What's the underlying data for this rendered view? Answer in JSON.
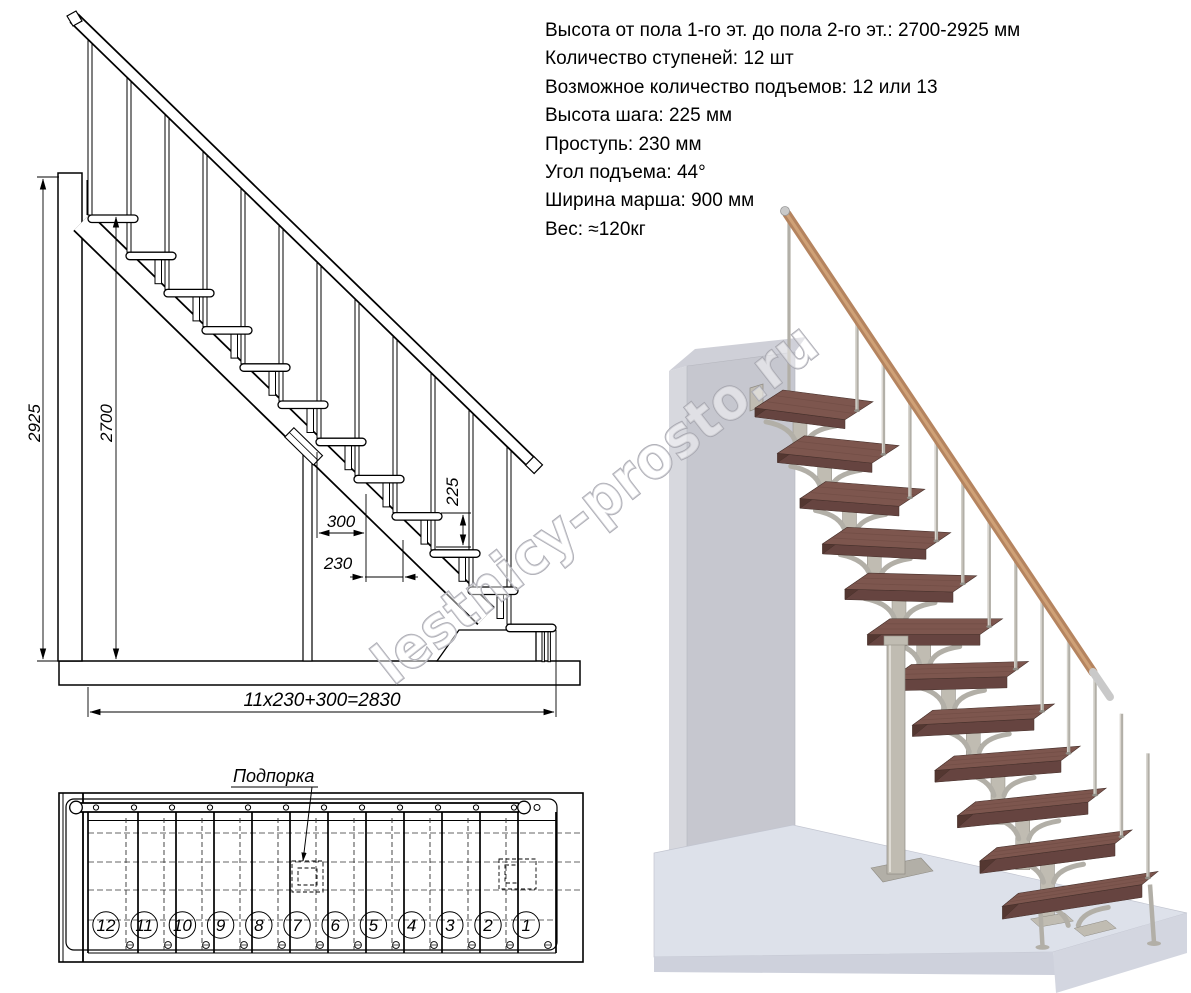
{
  "specs": {
    "lines": [
      "Высота от пола 1-го эт. до пола 2-го эт.: 2700-2925 мм",
      "Количество ступеней: 12 шт",
      "Возможное количество подъемов: 12 или 13",
      "Высота шага: 225 мм",
      "Проступь: 230 мм",
      "Угол подъема: 44°",
      "Ширина марша: 900 мм",
      "Вес: ≈120кг"
    ]
  },
  "side_view": {
    "dim_total_height": "2925",
    "dim_floor_height": "2700",
    "dim_step_run": "300",
    "dim_tread": "230",
    "dim_rise": "225",
    "dim_total_run": "11x230+300=2830",
    "step_count": 12
  },
  "plan_view": {
    "support_label": "Подпорка",
    "step_numbers": [
      "12",
      "11",
      "10",
      "9",
      "8",
      "7",
      "6",
      "5",
      "4",
      "3",
      "2",
      "1"
    ]
  },
  "watermark": "lestnicy-prosto.ru",
  "render_colors": {
    "tread_top": "#7d564e",
    "tread_front": "#664440",
    "tread_end": "#543731",
    "grain": "#6b4840",
    "rail": "#b5845f",
    "rail_highlight": "#d4a77c",
    "metal": "#b2afa7",
    "metal_light": "#dedbd4",
    "metal_edge": "#8f8c84",
    "bracket": "#c0bcb2",
    "wall_front": "#c6c7cf",
    "wall_side": "#d7d8de",
    "wall_top": "#cfd0d8",
    "floor_top": "#dde1ea",
    "floor_front": "#ced1dc",
    "floor_front2": "#d3d6e0",
    "cap": "#c9c9c9"
  }
}
